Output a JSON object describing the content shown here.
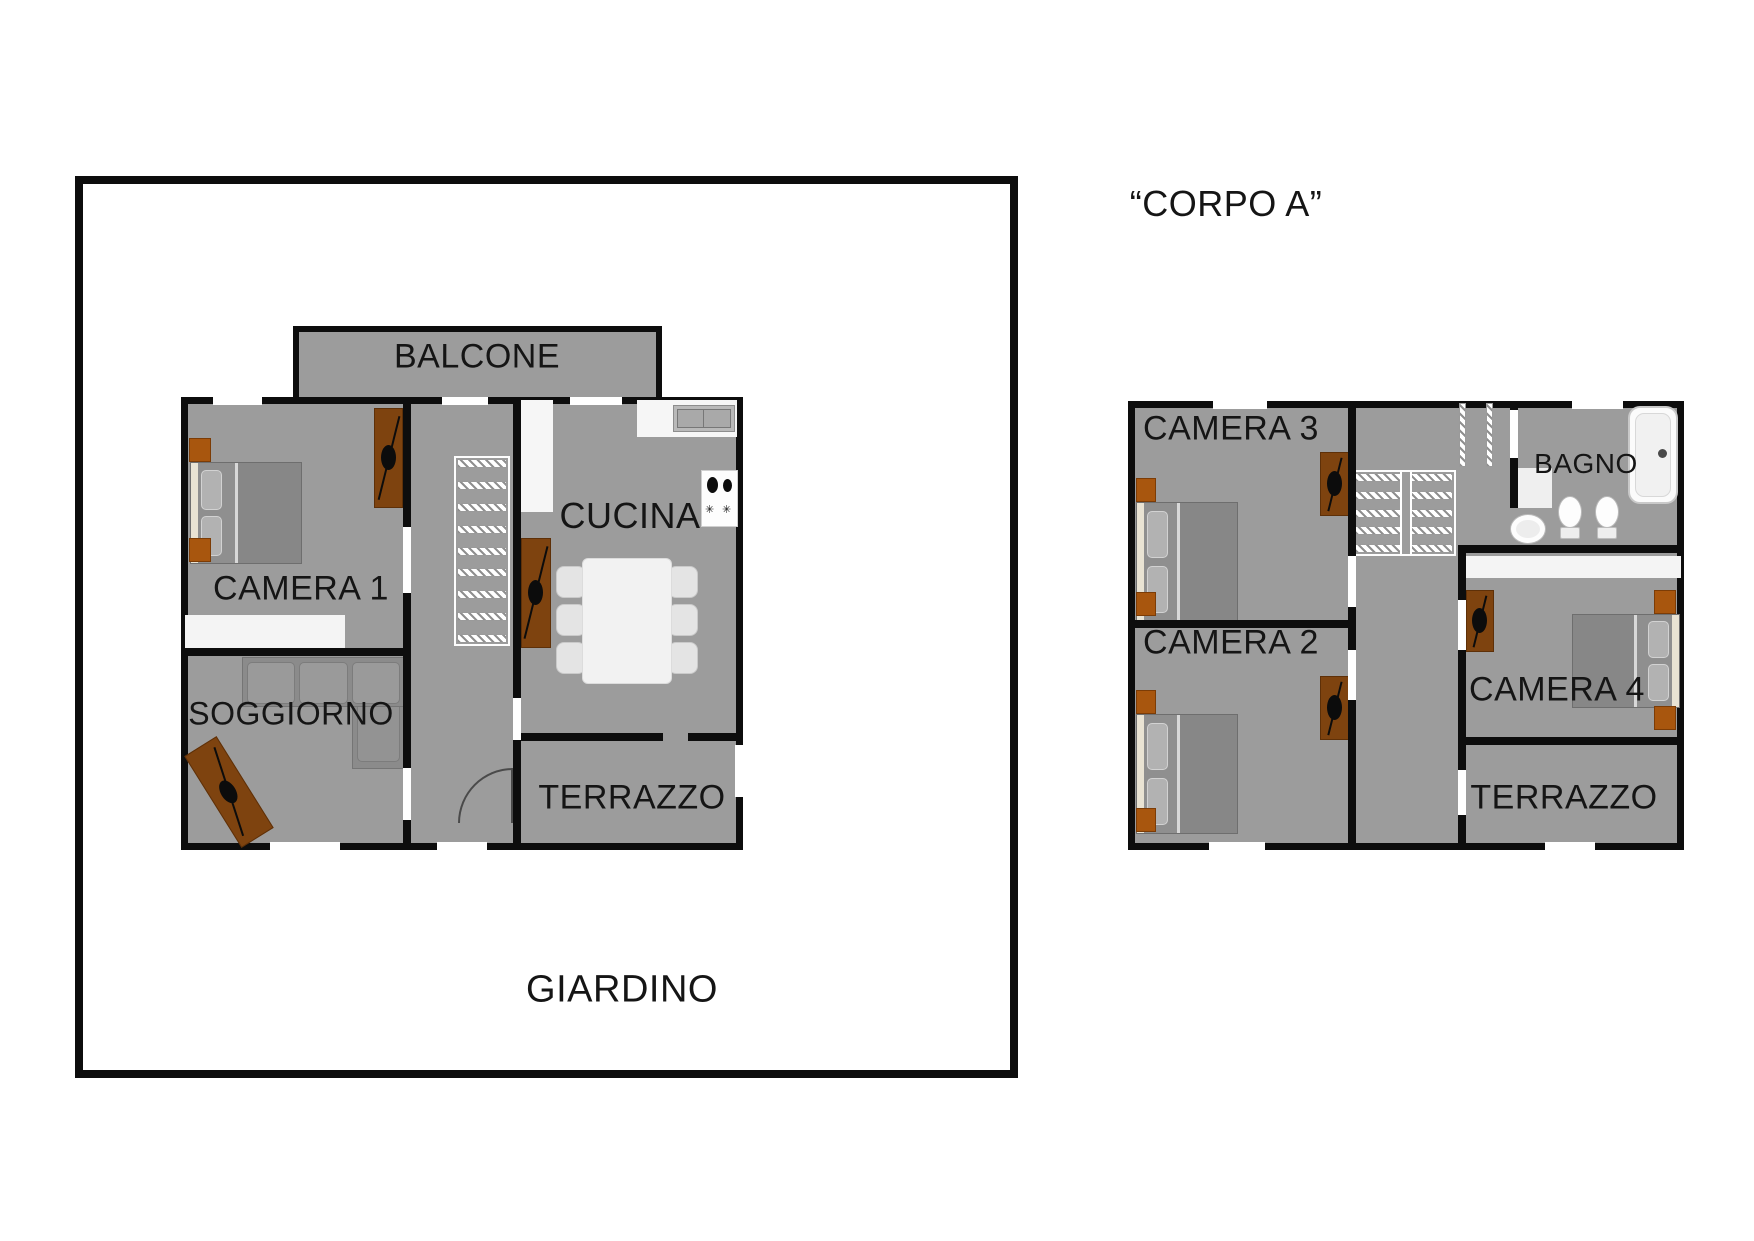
{
  "left_plan": {
    "garden_label": "GIARDINO",
    "rooms": {
      "balcone": "BALCONE",
      "camera1": "CAMERA 1",
      "cucina": "CUCINA",
      "soggiorno": "SOGGIORNO",
      "terrazzo": "TERRAZZO"
    }
  },
  "right_plan": {
    "title": "“CORPO A”",
    "rooms": {
      "camera3": "CAMERA 3",
      "camera2": "CAMERA 2",
      "bagno": "BAGNO",
      "camera4": "CAMERA 4",
      "terrazzo": "TERRAZZO"
    }
  },
  "icons": {
    "stove_burner": "✳"
  },
  "colors": {
    "room_fill": "#9c9c9c",
    "wall": "#0d0d0d",
    "rug": "#7e430f",
    "nightstand": "#a8560e",
    "counter": "#f6f6f6"
  }
}
